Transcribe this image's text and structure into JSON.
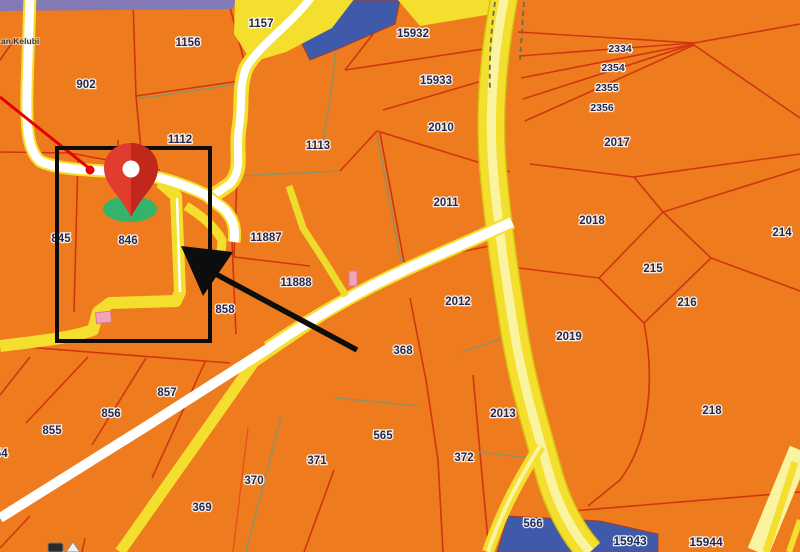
{
  "map": {
    "region_label": "an Kelubi",
    "parcel_labels": [
      {
        "t": "902",
        "x": 86,
        "y": 84
      },
      {
        "t": "1156",
        "x": 188,
        "y": 42
      },
      {
        "t": "1157",
        "x": 261,
        "y": 23
      },
      {
        "t": "15932",
        "x": 413,
        "y": 33
      },
      {
        "t": "15933",
        "x": 436,
        "y": 80
      },
      {
        "t": "2334",
        "x": 620,
        "y": 48,
        "fs": 10.5
      },
      {
        "t": "2354",
        "x": 613,
        "y": 67,
        "fs": 10.5
      },
      {
        "t": "2355",
        "x": 607,
        "y": 87,
        "fs": 10.5
      },
      {
        "t": "2356",
        "x": 602,
        "y": 107,
        "fs": 10.5
      },
      {
        "t": "2010",
        "x": 441,
        "y": 127
      },
      {
        "t": "2017",
        "x": 617,
        "y": 142
      },
      {
        "t": "1112",
        "x": 180,
        "y": 139
      },
      {
        "t": "1113",
        "x": 318,
        "y": 145
      },
      {
        "t": "2011",
        "x": 446,
        "y": 202
      },
      {
        "t": "2018",
        "x": 592,
        "y": 220
      },
      {
        "t": "214",
        "x": 782,
        "y": 232
      },
      {
        "t": "845",
        "x": 61,
        "y": 238
      },
      {
        "t": "846",
        "x": 128,
        "y": 240
      },
      {
        "t": "11887",
        "x": 266,
        "y": 237
      },
      {
        "t": "215",
        "x": 653,
        "y": 268
      },
      {
        "t": "11888",
        "x": 296,
        "y": 282
      },
      {
        "t": "216",
        "x": 687,
        "y": 302
      },
      {
        "t": "2012",
        "x": 458,
        "y": 301
      },
      {
        "t": "858",
        "x": 225,
        "y": 309
      },
      {
        "t": "2019",
        "x": 569,
        "y": 336
      },
      {
        "t": "368",
        "x": 403,
        "y": 350
      },
      {
        "t": "857",
        "x": 167,
        "y": 392
      },
      {
        "t": "856",
        "x": 111,
        "y": 413
      },
      {
        "t": "855",
        "x": 52,
        "y": 430
      },
      {
        "t": "854",
        "x": -2,
        "y": 453
      },
      {
        "t": "2013",
        "x": 503,
        "y": 413
      },
      {
        "t": "218",
        "x": 712,
        "y": 410
      },
      {
        "t": "565",
        "x": 383,
        "y": 435
      },
      {
        "t": "371",
        "x": 317,
        "y": 460
      },
      {
        "t": "372",
        "x": 464,
        "y": 457
      },
      {
        "t": "370",
        "x": 254,
        "y": 480
      },
      {
        "t": "369",
        "x": 202,
        "y": 507
      },
      {
        "t": "566",
        "x": 533,
        "y": 523
      },
      {
        "t": "15943",
        "x": 630,
        "y": 541,
        "fs": 12
      },
      {
        "t": "15944",
        "x": 706,
        "y": 542,
        "fs": 12
      }
    ]
  },
  "overlay": {
    "marker": {
      "type": "location-pin",
      "x": 131,
      "y": 217
    },
    "highlight_rect": {
      "x": 57,
      "y": 148,
      "w": 153,
      "h": 193
    },
    "arrow": {
      "from_x": 357,
      "from_y": 350,
      "to_x": 183,
      "to_y": 250
    },
    "leader_line": {
      "from_x": 0,
      "from_y": 97,
      "to_x": 90,
      "to_y": 169
    }
  },
  "colors": {
    "land": "#ee7c1e",
    "road_yellow": "#f5df2e",
    "road_pale": "#faf3a0",
    "road_white": "#ffffff",
    "water_blue": "#3f5aa8",
    "strip_purple": "#8379b4",
    "boundary_red": "#d03510",
    "boundary_gray": "#8f9163",
    "label_navy": "#1e2a55",
    "marker_red": "#e23c2e",
    "marker_dark_red": "#c1271a",
    "marker_green": "#35b36b",
    "annotation_black": "#0d0d0d",
    "building_pink": "#f2a3b8",
    "leader_red": "#e60000"
  }
}
